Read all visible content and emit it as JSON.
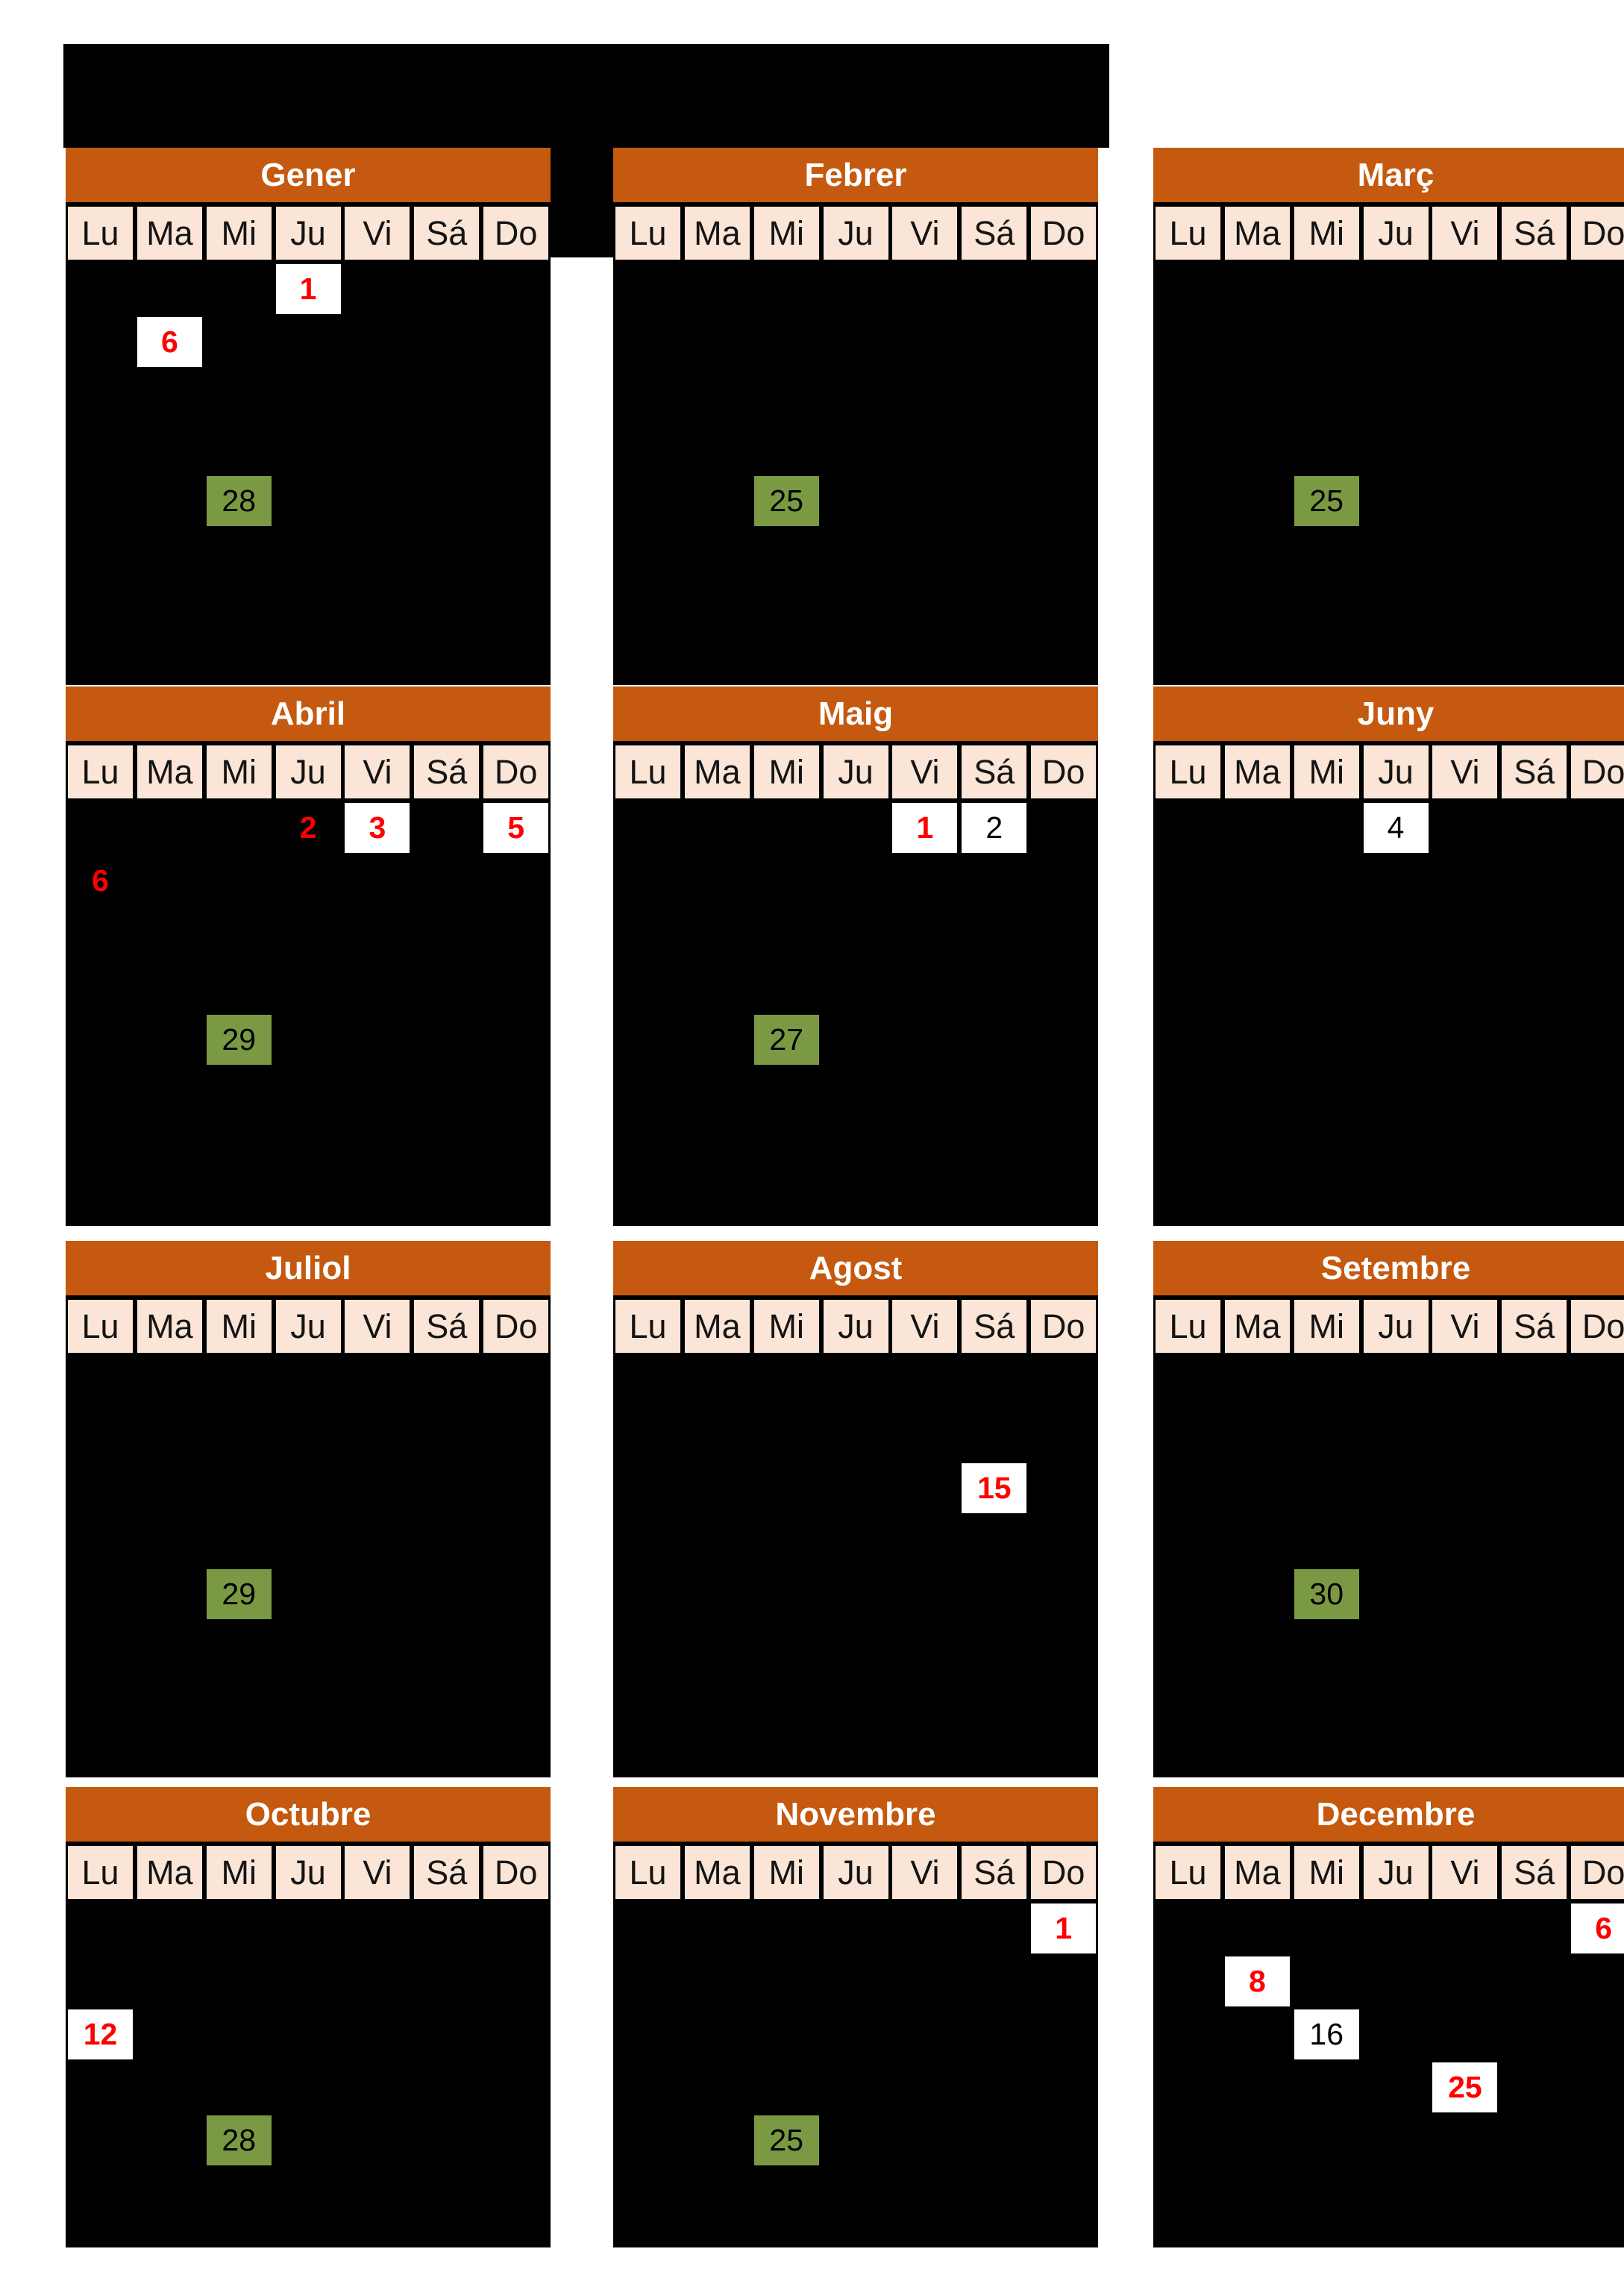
{
  "colors": {
    "page_background": "#FFFFFF",
    "table_background": "#000000",
    "month_header": "#C4590F",
    "weekday_cell": "#FBE5D6",
    "holiday_red": "#FF0000",
    "highlight_green": "#7B9943",
    "box_white": "#FFFFFF"
  },
  "weekdays": [
    "Lu",
    "Ma",
    "Mi",
    "Ju",
    "Vi",
    "Sá",
    "Do"
  ],
  "months": [
    {
      "name": "Gener",
      "dates": [
        {
          "day": "1",
          "weekday": "Ju",
          "col": 3,
          "week": 1,
          "style": "holiday-box"
        },
        {
          "day": "6",
          "weekday": "Ma",
          "col": 1,
          "week": 2,
          "style": "holiday-box"
        },
        {
          "day": "28",
          "weekday": "Mi",
          "col": 2,
          "week": 5,
          "style": "green-box"
        }
      ]
    },
    {
      "name": "Febrer",
      "dates": [
        {
          "day": "25",
          "weekday": "Mi",
          "col": 2,
          "week": 5,
          "style": "green-box"
        }
      ]
    },
    {
      "name": "Març",
      "dates": [
        {
          "day": "25",
          "weekday": "Mi",
          "col": 2,
          "week": 5,
          "style": "green-box"
        }
      ]
    },
    {
      "name": "Abril",
      "dates": [
        {
          "day": "2",
          "weekday": "Ju",
          "col": 3,
          "week": 1,
          "style": "holiday-text"
        },
        {
          "day": "3",
          "weekday": "Vi",
          "col": 4,
          "week": 1,
          "style": "holiday-box"
        },
        {
          "day": "5",
          "weekday": "Do",
          "col": 6,
          "week": 1,
          "style": "holiday-box"
        },
        {
          "day": "6",
          "weekday": "Lu",
          "col": 0,
          "week": 2,
          "style": "holiday-text"
        },
        {
          "day": "29",
          "weekday": "Mi",
          "col": 2,
          "week": 5,
          "style": "green-box"
        }
      ]
    },
    {
      "name": "Maig",
      "dates": [
        {
          "day": "1",
          "weekday": "Vi",
          "col": 4,
          "week": 1,
          "style": "holiday-box"
        },
        {
          "day": "2",
          "weekday": "Sá",
          "col": 5,
          "week": 1,
          "style": "plain-box"
        },
        {
          "day": "27",
          "weekday": "Mi",
          "col": 2,
          "week": 5,
          "style": "green-box"
        }
      ]
    },
    {
      "name": "Juny",
      "dates": [
        {
          "day": "4",
          "weekday": "Ju",
          "col": 3,
          "week": 1,
          "style": "plain-box"
        }
      ]
    },
    {
      "name": "Juliol",
      "dates": [
        {
          "day": "29",
          "weekday": "Mi",
          "col": 2,
          "week": 5,
          "style": "green-box"
        }
      ]
    },
    {
      "name": "Agost",
      "dates": [
        {
          "day": "15",
          "weekday": "Sá",
          "col": 5,
          "week": 3,
          "style": "holiday-box"
        }
      ]
    },
    {
      "name": "Setembre",
      "dates": [
        {
          "day": "30",
          "weekday": "Mi",
          "col": 2,
          "week": 5,
          "style": "green-box"
        }
      ]
    },
    {
      "name": "Octubre",
      "dates": [
        {
          "day": "12",
          "weekday": "Lu",
          "col": 0,
          "week": 3,
          "style": "holiday-box"
        },
        {
          "day": "28",
          "weekday": "Mi",
          "col": 2,
          "week": 5,
          "style": "green-box"
        }
      ]
    },
    {
      "name": "Novembre",
      "dates": [
        {
          "day": "1",
          "weekday": "Do",
          "col": 6,
          "week": 1,
          "style": "holiday-box"
        },
        {
          "day": "25",
          "weekday": "Mi",
          "col": 2,
          "week": 5,
          "style": "green-box"
        }
      ]
    },
    {
      "name": "Decembre",
      "dates": [
        {
          "day": "6",
          "weekday": "Do",
          "col": 6,
          "week": 1,
          "style": "holiday-box"
        },
        {
          "day": "8",
          "weekday": "Ma",
          "col": 1,
          "week": 2,
          "style": "holiday-box"
        },
        {
          "day": "16",
          "weekday": "Mi",
          "col": 2,
          "week": 3,
          "style": "plain-box"
        },
        {
          "day": "25",
          "weekday": "Vi",
          "col": 4,
          "week": 4,
          "style": "holiday-box"
        }
      ]
    }
  ]
}
